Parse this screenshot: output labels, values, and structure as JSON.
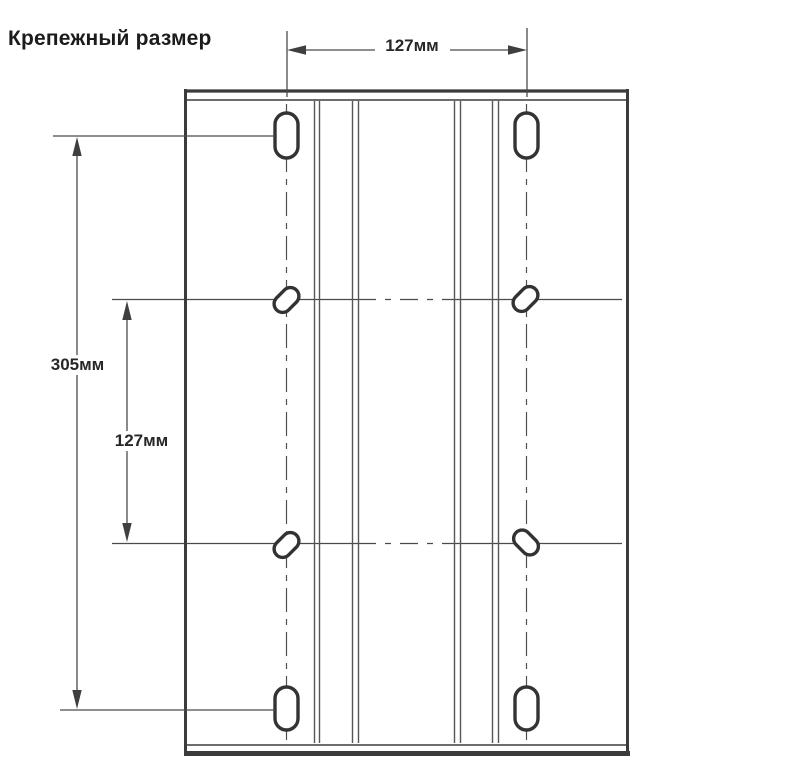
{
  "title": "Крепежный размер",
  "labels": {
    "top_width": "127мм",
    "overall_height": "305мм",
    "middle_spacing": "127мм"
  },
  "colors": {
    "background": "#ffffff",
    "plate_line": "#3b3b3b",
    "thin_line": "#565656",
    "dimension_line": "#4a4a4a",
    "text": "#1c1c1c"
  }
}
